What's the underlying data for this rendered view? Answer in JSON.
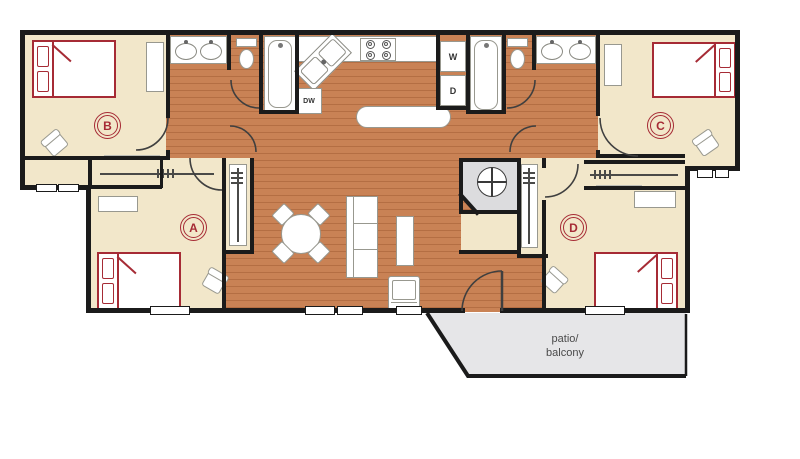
{
  "rooms": {
    "bedroom_a": {
      "label": "A"
    },
    "bedroom_b": {
      "label": "B"
    },
    "bedroom_c": {
      "label": "C"
    },
    "bedroom_d": {
      "label": "D"
    },
    "patio": {
      "label_line1": "patio/",
      "label_line2": "balcony"
    }
  },
  "appliances": {
    "washer": "W",
    "dryer": "D",
    "dishwasher": "DW"
  },
  "colors": {
    "wall": "#1b1b1b",
    "wood_floor": "#c98255",
    "room_cream": "#f2e7ca",
    "utility_gray": "#dcdcde",
    "fixture_border": "#98988f",
    "furniture_red": "#a62b35",
    "patio_gray": "#e6e6e8",
    "patio_text": "#4a4a4a"
  }
}
